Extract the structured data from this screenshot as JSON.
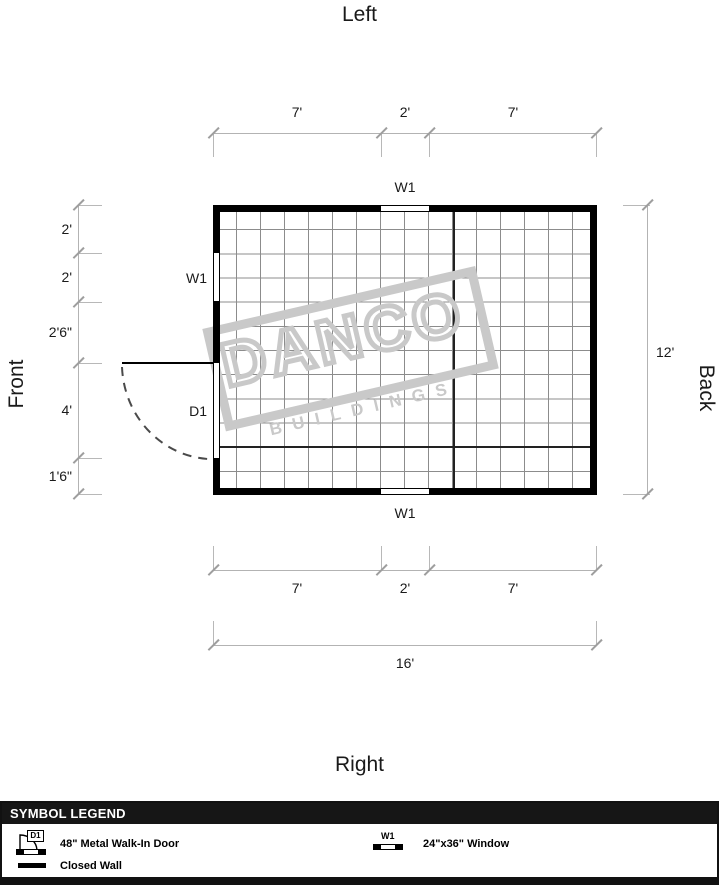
{
  "titles": {
    "top": "Left",
    "bottom": "Right",
    "left": "Front",
    "right": "Back"
  },
  "dimensions": {
    "top": [
      "7'",
      "2'",
      "7'"
    ],
    "left": [
      "2'",
      "2'",
      "2'6\"",
      "4'",
      "1'6\""
    ],
    "right_total": "12'",
    "bottom": [
      "7'",
      "2'",
      "7'"
    ],
    "bottom_total": "16'"
  },
  "plan": {
    "top_window_label": "W1",
    "left_window_label": "W1",
    "door_label": "D1",
    "bottom_window_label": "W1"
  },
  "watermark": {
    "line1": "DANCO",
    "line2": "BUILDINGS"
  },
  "legend": {
    "header": "SYMBOL LEGEND",
    "door": {
      "code": "D1",
      "label": "48\" Metal Walk-In Door"
    },
    "window": {
      "code": "W1",
      "label": "24\"x36\" Window"
    },
    "closed_wall": {
      "label": "Closed Wall"
    }
  },
  "colors": {
    "wall": "#000000",
    "grid": "#8c8c8c",
    "grid_major": "#222222",
    "dimension_line": "#b3b3b3",
    "door_swing": "#4a4a4a",
    "watermark": "#c9c9c9",
    "legend_header_bg": "#161616",
    "legend_header_text": "#ffffff"
  }
}
